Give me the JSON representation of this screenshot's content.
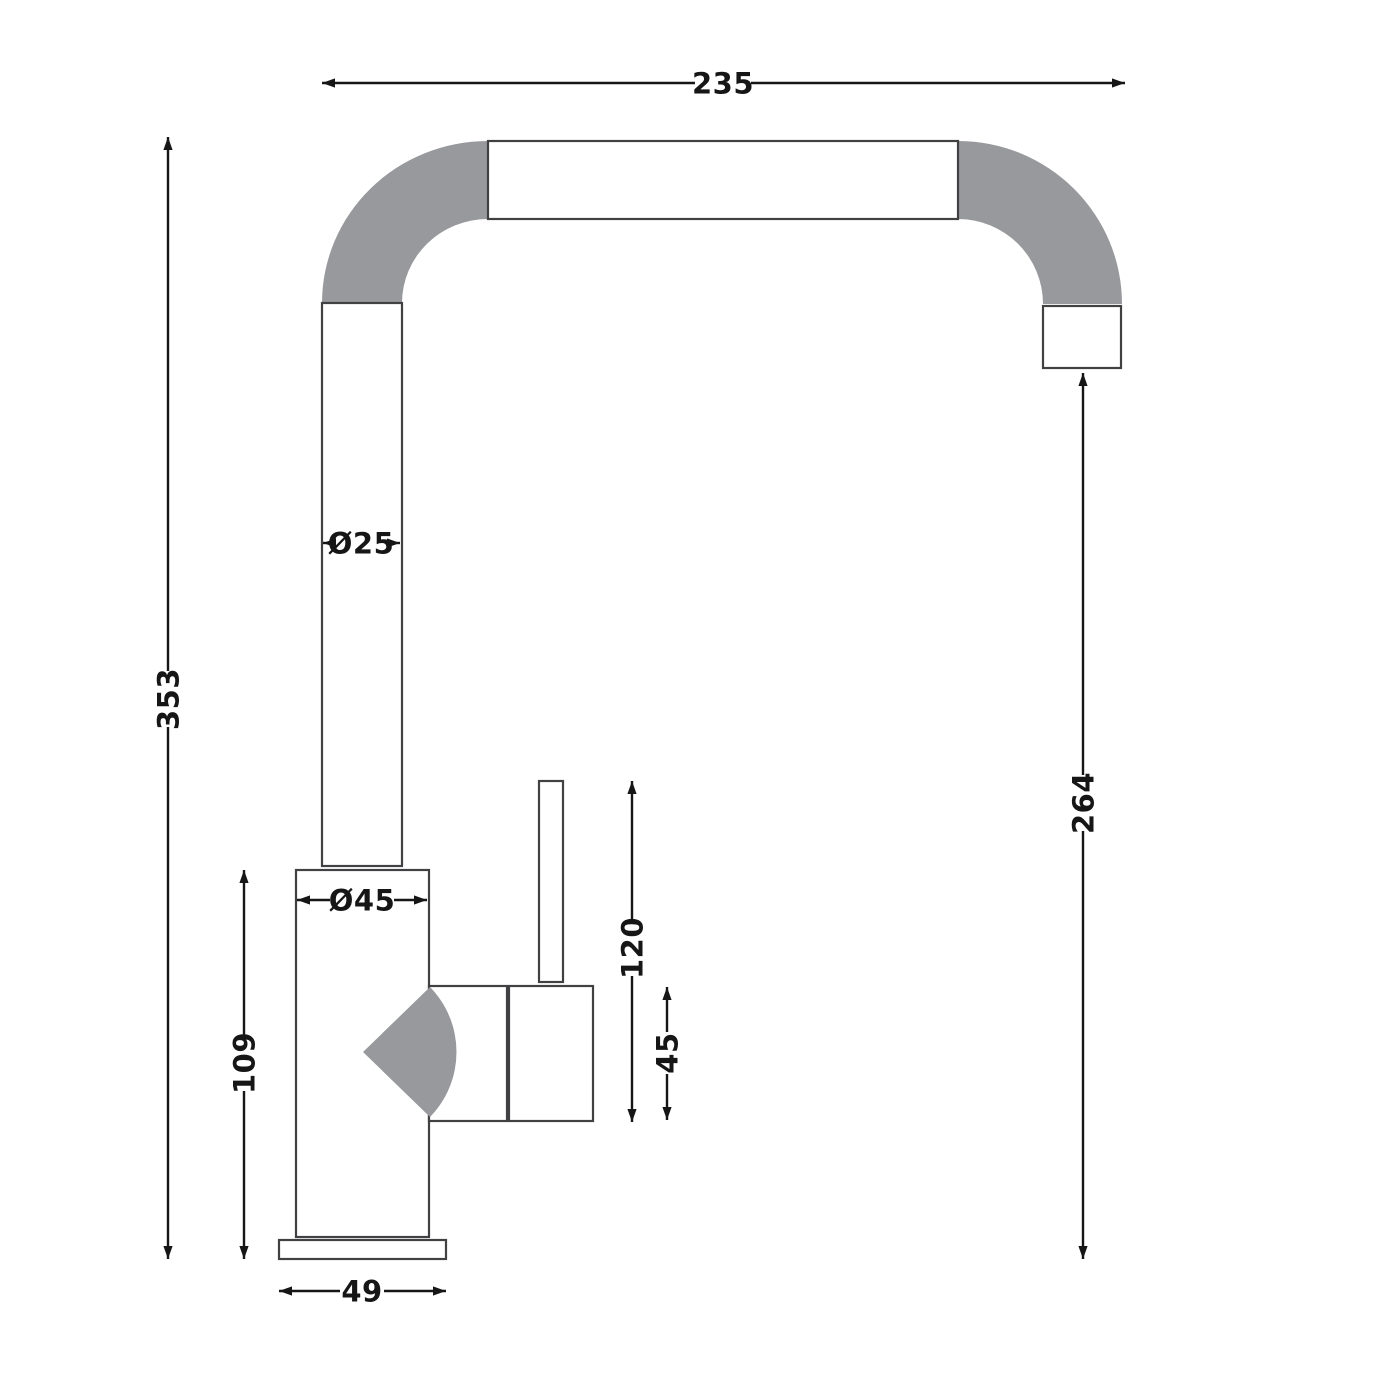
{
  "colors": {
    "background": "#ffffff",
    "part_fill": "#ffffff",
    "part_outline": "#414143",
    "bend_gray": "#98999c",
    "dim_color": "#161616"
  },
  "dimensions": {
    "overall_width": "235",
    "overall_height": "353",
    "spout_tube_diameter": "Ø25",
    "body_diameter": "Ø45",
    "body_height": "109",
    "base_width": "49",
    "handle_total_height": "120",
    "handle_body_height": "45",
    "outlet_to_base_height": "264"
  }
}
